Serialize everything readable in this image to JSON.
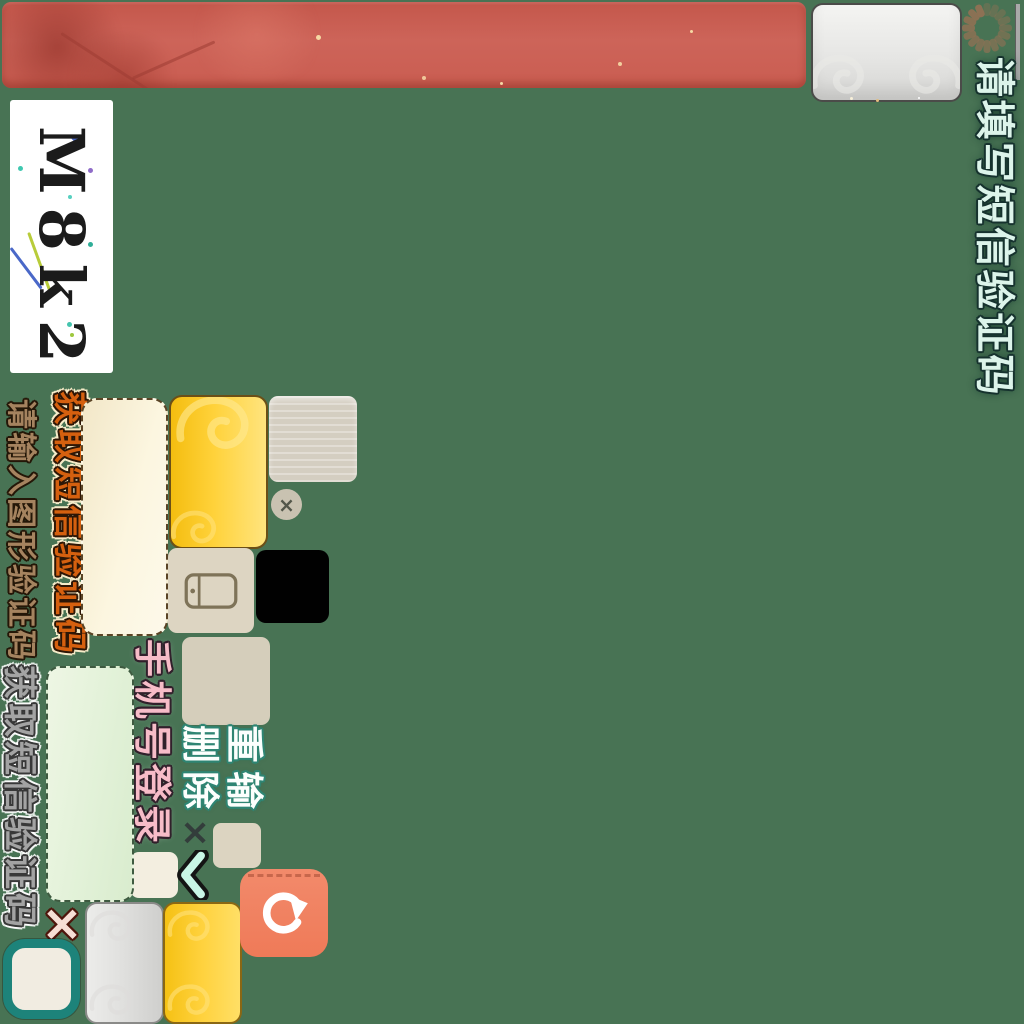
{
  "colors": {
    "background": "#487354",
    "banner_red": "#ca5d51",
    "gold": "#ffd23a",
    "teal_frame": "#1d837a",
    "orange_text": "#d5600f",
    "refresh_orange": "#f0815f",
    "pink_text": "#f7bcc8",
    "mint_chevron": "#c9f6e6"
  },
  "header": {
    "right_vertical_title": "请填写短信验证码"
  },
  "captcha": {
    "code": "M8k2"
  },
  "labels": {
    "get_sms_code": "获取短信验证码",
    "enter_graphic_code": "请输入图形验证码",
    "get_sms_code_2": "获取短信验证码",
    "phone_login": "手机号登录",
    "delete": "删除",
    "reenter": "重输"
  },
  "symbols": {
    "close": "×",
    "chevron_left": "<"
  },
  "icons": {
    "spinner": "loading-spinner",
    "phone": "smartphone",
    "refresh": "refresh-arrow",
    "cloud": "cloud-motif"
  },
  "spinner": {
    "segments": 16,
    "color": "#8d7154"
  }
}
